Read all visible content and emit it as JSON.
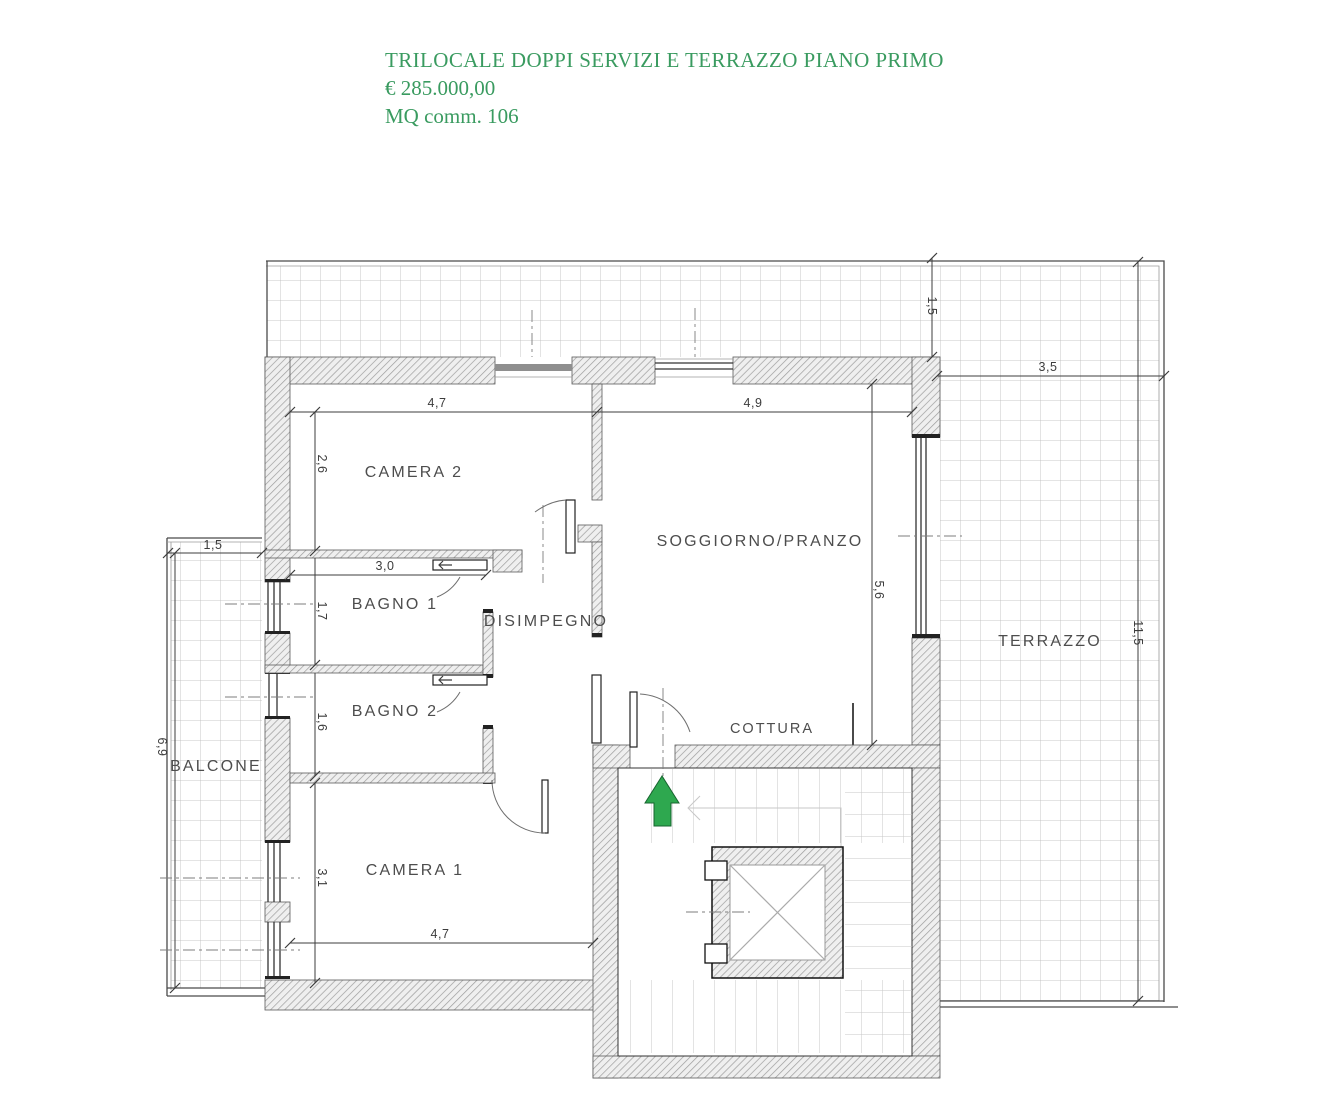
{
  "header": {
    "title": "TRILOCALE DOPPI SERVIZI E TERRAZZO PIANO PRIMO",
    "price": "€ 285.000,00",
    "area": "MQ comm. 106"
  },
  "colors": {
    "header_green": "#3a9b60",
    "arrow_green": "#2ea84f",
    "hatch_gray": "#9d9d9d",
    "tile_gray": "#b9b9b9",
    "label_gray": "#4d4d4d",
    "dim_gray": "#3c3c3c",
    "stair_gray": "#c7c7c7"
  },
  "rooms": {
    "camera2": "CAMERA 2",
    "bagno1": "BAGNO 1",
    "disimpegno": "DISIMPEGNO",
    "bagno2": "BAGNO 2",
    "camera1": "CAMERA 1",
    "soggiorno": "SOGGIORNO/PRANZO",
    "cottura": "COTTURA",
    "terrazzo": "TERRAZZO",
    "balcone": "BALCONE"
  },
  "dimensions": {
    "camera2_width": "4,7",
    "soggiorno_width": "4,9",
    "camera2_depth": "2,6",
    "bagno1_width": "3,0",
    "bagno1_depth": "1,7",
    "bagno2_depth": "1,6",
    "camera1_depth": "3,1",
    "camera1_width": "4,7",
    "soggiorno_depth": "5,6",
    "terrace_top_depth": "1,5",
    "terrace_right_width": "3,5",
    "terrace_right_length": "11,5",
    "balcone_width": "1,5",
    "balcone_length": "6,9"
  },
  "icons": {
    "entrance_arrow": "entrance-direction-up",
    "elevator": "elevator-shaft-cross",
    "stairs": "staircase"
  }
}
